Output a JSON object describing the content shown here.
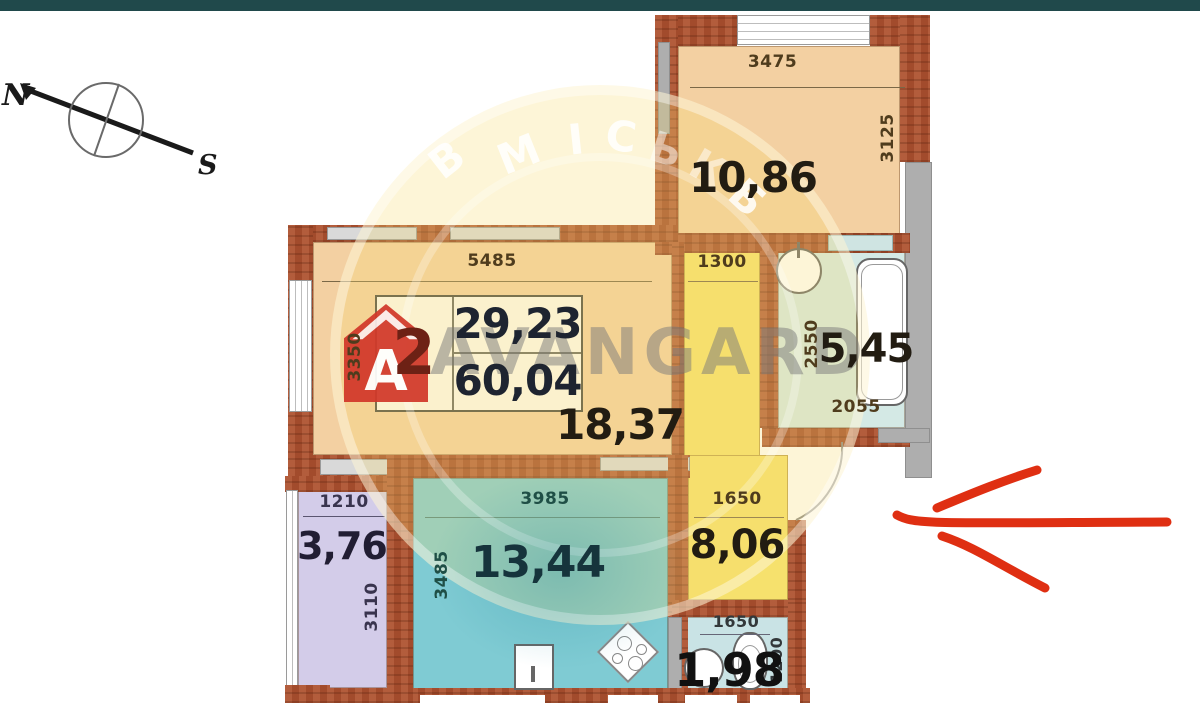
{
  "window": {
    "top_bar_color": "#20494b"
  },
  "compass": {
    "north": "N",
    "south": "S"
  },
  "watermark": {
    "brand": "AVANGARD",
    "logo_letter": "A",
    "emblem_letters": [
      "В",
      "М",
      "І",
      "С",
      "Ь",
      "К",
      "Б"
    ]
  },
  "annotation": {
    "description": "hand-drawn red arrow pointing left toward apartment entrance",
    "color": "#df2f12"
  },
  "plan": {
    "summary": {
      "rooms_count": "2",
      "living_area": "29,23",
      "total_area": "60,04"
    },
    "rooms": {
      "bedroom": {
        "area": "10,86",
        "dim_width": "3475",
        "dim_height": "3125"
      },
      "living": {
        "area": "18,37",
        "dim_width": "5485",
        "dim_height": "3350"
      },
      "corridor": {
        "dim_width": "1300"
      },
      "bathroom": {
        "area": "5,45",
        "dim_height": "2550",
        "dim_width": "2055"
      },
      "kitchen": {
        "area": "13,44",
        "dim_width": "3985",
        "dim_height": "3485"
      },
      "loggia": {
        "area": "3,76",
        "dim_width": "1210",
        "dim_height": "3110"
      },
      "hallway": {
        "area": "8,06",
        "dim_width": "1650"
      },
      "wc": {
        "area": "1,98",
        "dim_width": "1650",
        "dim_height": "1200"
      }
    },
    "colors": {
      "wall_brick": "#ad5130",
      "room_peach": "#f3d0a2",
      "corridor_yellow": "#f6e16d",
      "bathroom_blue": "#d4e9e5",
      "kitchen_teal": "#7fcbd3",
      "loggia_lavender": "#d3cce9",
      "panel_gray": "#aeaeae"
    }
  }
}
